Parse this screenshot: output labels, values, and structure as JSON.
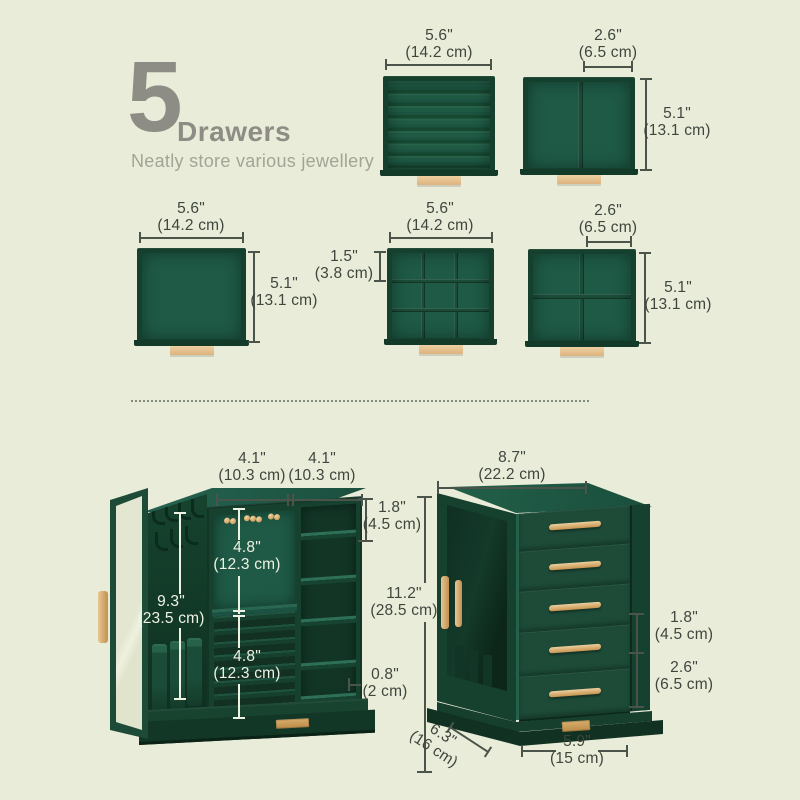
{
  "title": {
    "number": "5",
    "word": "Drawers",
    "subtitle": "Neatly store various jewellery"
  },
  "colors": {
    "background": "#e9ecd8",
    "cabinet_green": "#1d4b38",
    "velvet_green": "#1e5a46",
    "frame_green": "#16402e",
    "gold": "#d4a261",
    "tan_handle": "#e8c795",
    "dim_text_dark": "#3e463e",
    "dim_text_light": "#eef2e3",
    "title_gray": "#8d8d85"
  },
  "figures": {
    "ring": {
      "w_in": "5.6\"",
      "w_cm": "(14.2 cm)"
    },
    "two": {
      "w_in": "2.6\"",
      "w_cm": "(6.5 cm)",
      "h_in": "5.1\"",
      "h_cm": "(13.1 cm)"
    },
    "open": {
      "w_in": "5.6\"",
      "w_cm": "(14.2 cm)",
      "h_in": "5.1\"",
      "h_cm": "(13.1 cm)"
    },
    "grid9": {
      "w_in": "5.6\"",
      "w_cm": "(14.2 cm)",
      "cell_in": "1.5\"",
      "cell_cm": "(3.8 cm)"
    },
    "grid4": {
      "w_in": "2.6\"",
      "w_cm": "(6.5 cm)",
      "h_in": "5.1\"",
      "h_cm": "(13.1 cm)"
    }
  },
  "open_cabinet": {
    "top_left_in": "4.1\"",
    "top_left_cm": "(10.3 cm)",
    "top_right_in": "4.1\"",
    "top_right_cm": "(10.3 cm)",
    "shelf_in": "1.8\"",
    "shelf_cm": "(4.5 cm)",
    "upper_in": "4.8\"",
    "upper_cm": "(12.3 cm)",
    "height_in": "9.3\"",
    "height_cm": "(23.5 cm)",
    "lower_in": "4.8\"",
    "lower_cm": "(12.3 cm)",
    "base_in": "0.8\"",
    "base_cm": "(2 cm)"
  },
  "closed_cabinet": {
    "width_in": "8.7\"",
    "width_cm": "(22.2 cm)",
    "height_in": "11.2\"",
    "height_cm": "(28.5 cm)",
    "drawer_in": "1.8\"",
    "drawer_cm": "(4.5 cm)",
    "bottom_drawer_in": "2.6\"",
    "bottom_drawer_cm": "(6.5 cm)",
    "depth_in": "6.3\"",
    "depth_cm": "(16 cm)",
    "bottom_width_in": "5.9\"",
    "bottom_width_cm": "(15 cm)"
  }
}
